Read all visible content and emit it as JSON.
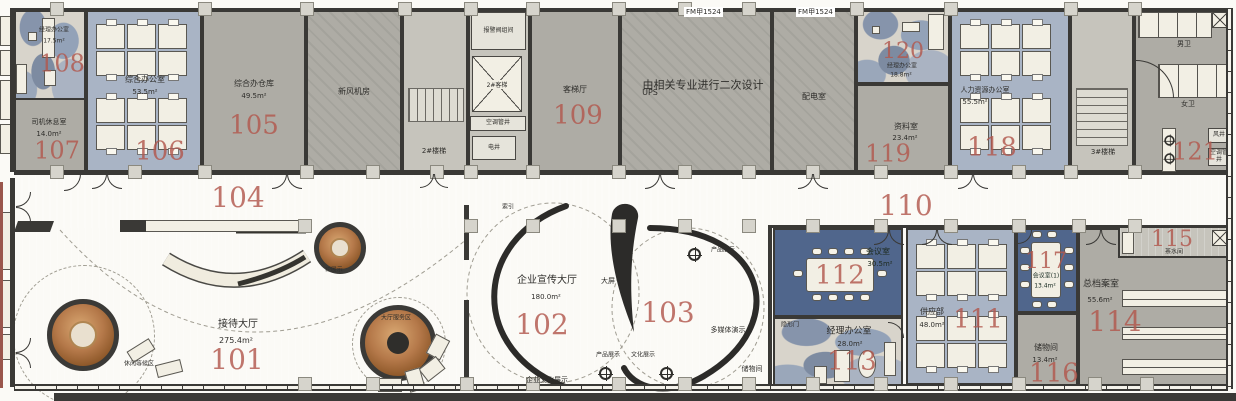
{
  "colors": {
    "room_number": "#b2584e",
    "floor_gray": "#aeaca5",
    "floor_blue": "#a9b4c5",
    "floor_blue_dark": "#50668c",
    "floor_cream": "#e9e6da",
    "copper": "#b57b4e",
    "wall": "#3a3936"
  },
  "rooms": {
    "r101": {
      "num": "101",
      "name": "接待大厅",
      "area": "275.4m²"
    },
    "r102": {
      "num": "102",
      "name": "企业宣传大厅",
      "area": "180.0m²"
    },
    "r103": {
      "num": "103"
    },
    "r104": {
      "num": "104"
    },
    "r105": {
      "num": "105",
      "name": "综合办仓库",
      "area": "49.5m²"
    },
    "r106": {
      "num": "106",
      "name": "综合办公室",
      "area": "53.5m²"
    },
    "r107": {
      "num": "107",
      "name": "司机休息室",
      "area": "14.0m²"
    },
    "r108": {
      "num": "108",
      "name": "经理办公室",
      "area": "17.5m²"
    },
    "r109": {
      "num": "109",
      "name": "客梯厅"
    },
    "r110": {
      "num": "110"
    },
    "r111": {
      "num": "111",
      "name": "供应部",
      "area": "48.0m²"
    },
    "r112": {
      "num": "112",
      "name": "会议室",
      "area": "30.5m²"
    },
    "r113": {
      "num": "113",
      "name": "经理办公室",
      "area": "28.0m²"
    },
    "r114": {
      "num": "114",
      "name": "总档案室",
      "area": "55.6m²"
    },
    "r115": {
      "num": "115",
      "name": "茶水间"
    },
    "r116": {
      "num": "116",
      "name": "储物间",
      "area": "13.4m²"
    },
    "r117": {
      "num": "117",
      "name": "会议室(1)",
      "area": "13.4m²"
    },
    "r118": {
      "num": "118",
      "name": "人力资源办公室",
      "area": "55.5m²"
    },
    "r119": {
      "num": "119",
      "name": "资料室",
      "area": "23.4m²"
    },
    "r120": {
      "num": "120",
      "name": "经理办公室",
      "area": "18.8m²"
    },
    "r121": {
      "num": "121"
    }
  },
  "service": {
    "fresh_air": "新风机房",
    "stair2": "2#楼梯",
    "stair3": "3#楼梯",
    "alarm_valve": "报警阀组间",
    "elevator": "2#客梯",
    "ac_shaft": "空调管井",
    "elec_shaft": "电井",
    "air_shaft": "风井",
    "ups": "UPS",
    "secondary_design": "由相关专业进行二次设计",
    "distribution": "配电室",
    "fire_door": "FM甲1524",
    "mens": "男卫",
    "womens": "女卫"
  },
  "zones": {
    "waiting": "休闲等候区",
    "ip_display": "IP展示",
    "hall_service": "大厅服务区",
    "index": "索引",
    "big_screen": "大屏",
    "product_display": "产品展示",
    "culture_wall": "企业文化展示",
    "culture_display": "文化展示",
    "multimedia": "多媒体演示",
    "storage": "储物间",
    "hidden_door": "隐形门"
  }
}
